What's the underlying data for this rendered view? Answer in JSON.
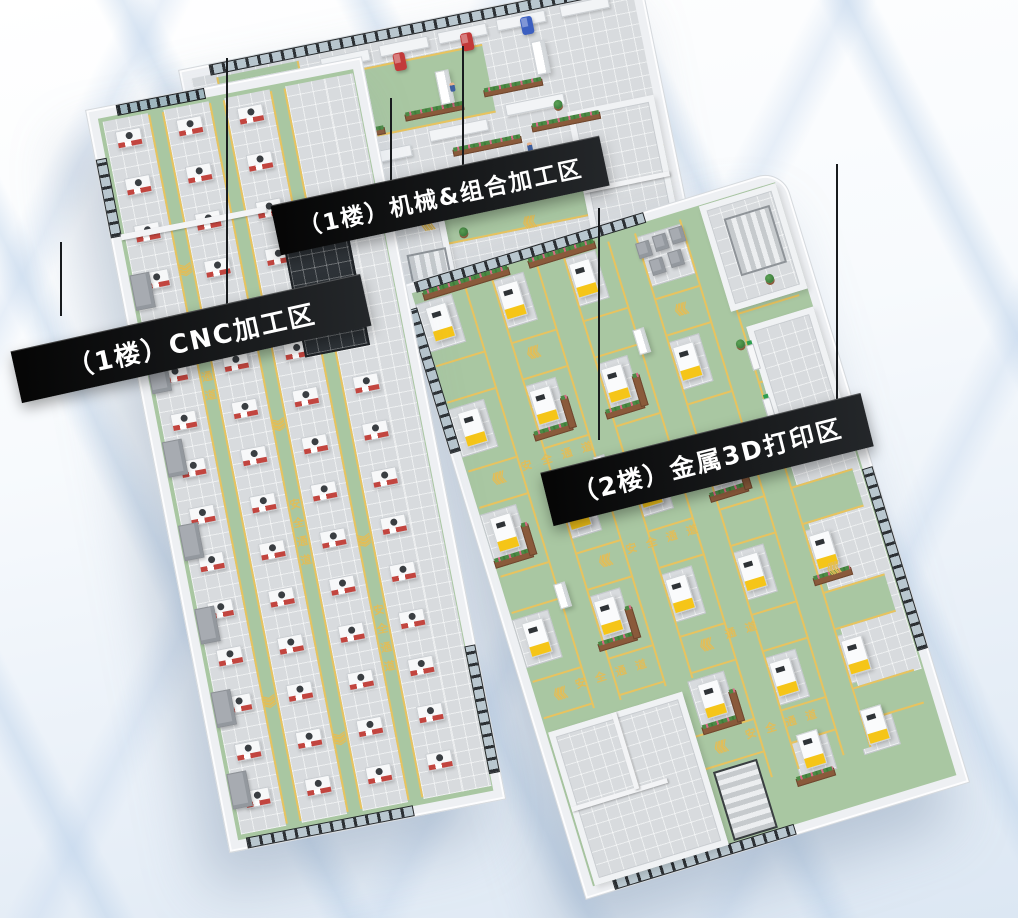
{
  "areas": [
    {
      "id": "cnc-zone",
      "label": "（1楼）CNC加工区"
    },
    {
      "id": "machining-zone",
      "label": "（1楼）机械&组合加工区"
    },
    {
      "id": "printing-zone",
      "label": "（2楼）金属3D打印区"
    }
  ],
  "markings": {
    "safety_lane_text": "安全通道",
    "lane_text_short": "通道",
    "chevrons": "《《《"
  },
  "colors": {
    "floor_green": "#a9c7a2",
    "lane_yellow": "#e8c35f",
    "tile_gray": "#d8dbde",
    "wall_white": "#eef0f3",
    "window_frame": "#2c3034",
    "banner_bg": "#121212",
    "banner_text": "#ffffff",
    "printer_accent": "#f5c518",
    "cnc_accent": "#c2453f",
    "planter_brown": "#8a5a3b",
    "plant_green": "#4c8a45",
    "flower_pink": "#d66a85",
    "robot_blue": "#3c5fc0",
    "robot_green": "#4f9c68",
    "robot_red": "#c23a3a",
    "background_tint": "#dce7f3"
  }
}
